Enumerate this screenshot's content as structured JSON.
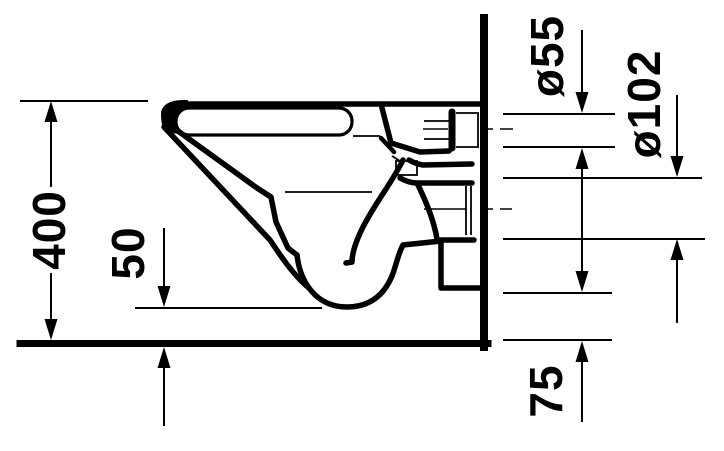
{
  "drawing": {
    "subject": "wall-hung toilet side elevation technical drawing",
    "colors": {
      "line": "#000000",
      "background": "#ffffff"
    },
    "dimension_labels": {
      "overall_height": "400",
      "bowl_bottom_clearance": "50",
      "inlet_diameter": "ø55",
      "outlet_diameter": "ø102",
      "outlet_bottom_height": "75"
    }
  }
}
